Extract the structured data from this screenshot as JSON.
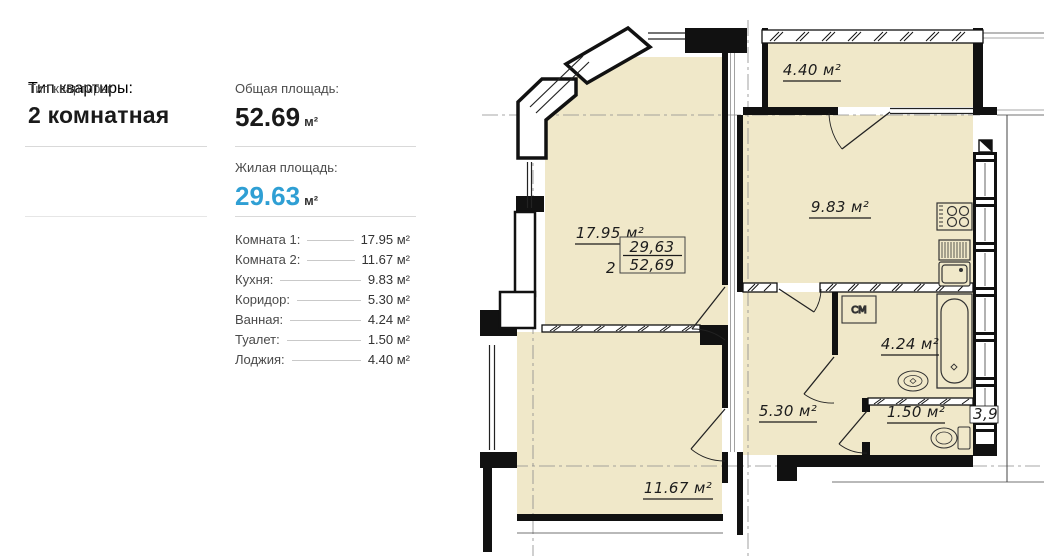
{
  "panel": {
    "type_label": "Тип квартиры:",
    "type_value": "2 комнатная",
    "total_label": "Общая площадь:",
    "total_value": "52.69",
    "total_unit": "м²",
    "living_label": "Жилая площадь:",
    "living_value": "29.63",
    "living_unit": "м²",
    "rooms": [
      {
        "label": "Комната 1:",
        "value": "17.95 м²"
      },
      {
        "label": "Комната 2:",
        "value": "11.67 м²"
      },
      {
        "label": "Кухня:",
        "value": "9.83 м²"
      },
      {
        "label": "Коридор:",
        "value": "5.30 м²"
      },
      {
        "label": "Ванная:",
        "value": "4.24 м²"
      },
      {
        "label": "Туалет:",
        "value": "1.50 м²"
      },
      {
        "label": "Лоджия:",
        "value": "4.40 м²"
      }
    ]
  },
  "plan": {
    "room_main": "17.95 м²",
    "room_second": "11.67 м²",
    "kitchen": "9.83 м²",
    "loggia": "4.40 м²",
    "bathroom": "4.24 м²",
    "hallway": "5.30 м²",
    "wc": "1.50 м²",
    "apartment_number": "2",
    "living_area": "29,63",
    "total_area": "52,69",
    "washing_machine_label": "СМ",
    "edge_dimension": "3,9"
  },
  "colors": {
    "accent_blue": "#2f9fd4",
    "room_fill": "#f0e8c9",
    "wall": "#111111",
    "separator": "#d9d9d9"
  }
}
